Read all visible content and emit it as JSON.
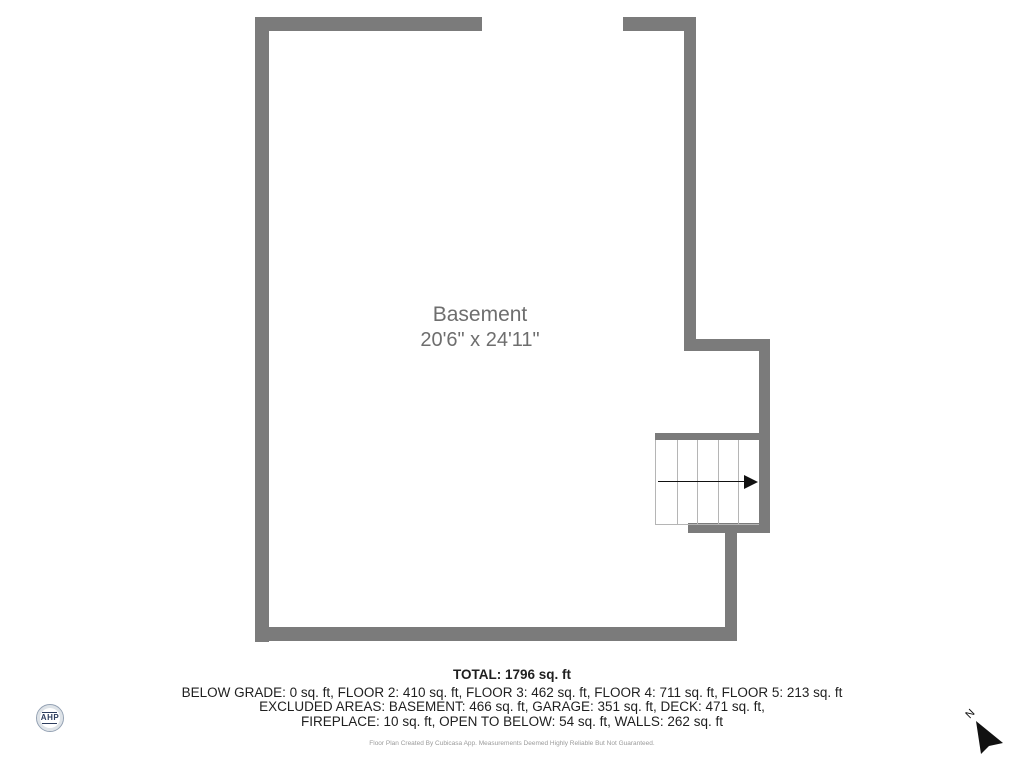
{
  "colors": {
    "wall": "#7b7b7b",
    "room_label": "#6e6e6e",
    "stair_line": "#b5b5b5",
    "footer_text": "#1f1f1f",
    "disclaimer_text": "#9b9b9b",
    "logo_navy": "#2d3d5e",
    "arrow_black": "#111111"
  },
  "floorplan": {
    "room_name": "Basement",
    "room_dimensions": "20'6\" x 24'11\"",
    "stairs_direction": "right"
  },
  "footer": {
    "total": "TOTAL: 1796 sq. ft",
    "areas_line": "BELOW GRADE: 0 sq. ft, FLOOR 2: 410 sq. ft, FLOOR 3: 462 sq. ft, FLOOR 4: 711 sq. ft, FLOOR 5: 213 sq. ft",
    "excluded_line1": "EXCLUDED AREAS: BASEMENT: 466 sq. ft, GARAGE: 351 sq. ft, DECK: 471 sq. ft,",
    "excluded_line2": "FIREPLACE: 10 sq. ft, OPEN TO BELOW: 54 sq. ft, WALLS: 262 sq. ft",
    "disclaimer": "Floor Plan Created By Cubicasa App. Measurements Deemed Highly Reliable But Not Guaranteed."
  },
  "branding": {
    "logo_text": "AHP"
  },
  "compass": {
    "north_label": "N"
  }
}
